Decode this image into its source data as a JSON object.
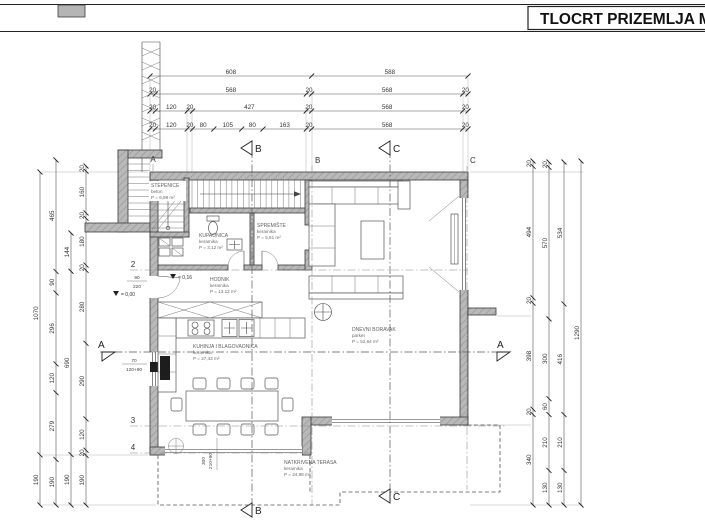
{
  "header": {
    "title": "TLOCRT PRIZEMLJA  M"
  },
  "rooms": [
    {
      "name": "STEPENICE",
      "material": "beton",
      "area": "P = 6,98 m²"
    },
    {
      "name": "KUPAONICA",
      "material": "keramika",
      "area": "P = 3,12 m²"
    },
    {
      "name": "SPREMIŠTE",
      "material": "keramika",
      "area": "P = 5,61 m²"
    },
    {
      "name": "HODNIK",
      "material": "keramika",
      "area": "P = 13,12 m²"
    },
    {
      "name": "KUHINJA I BLAGOVAONICA",
      "material": "keramika",
      "area": "P = 27,43 m²"
    },
    {
      "name": "DNEVNI BORAVAK",
      "material": "parket",
      "area": "P = 52,64 m²"
    },
    {
      "name": "NATKRIVENA TERASA",
      "material": "keramika",
      "area": "P = 24,98 m²"
    }
  ],
  "dims": {
    "top1": [
      "608",
      "588"
    ],
    "top2": [
      "20",
      "568",
      "20",
      "568",
      "20"
    ],
    "top3": [
      "20",
      "120",
      "20",
      "427",
      "20",
      "568",
      "20"
    ],
    "top4": [
      "20",
      "120",
      "20",
      "80",
      "105",
      "80",
      "163",
      "20",
      "568",
      "20"
    ],
    "left1": [
      "1070",
      "190"
    ],
    "left2": [
      "465",
      "90",
      "296",
      "120",
      "279",
      "190"
    ],
    "left3": [
      "144",
      "690",
      "190"
    ],
    "left4": [
      "20",
      "160",
      "20",
      "180",
      "20",
      "280",
      "290",
      "120",
      "20",
      "190"
    ],
    "right1": [
      "20",
      "494",
      "20",
      "398",
      "20",
      "340"
    ],
    "right2": [
      "20",
      "570",
      "300",
      "60",
      "210",
      "130"
    ],
    "right3": [
      "534",
      "416",
      "210",
      "130"
    ],
    "right4": [
      "1290"
    ]
  },
  "grid": {
    "a": "A",
    "b": "B",
    "c": "C",
    "n2": "2",
    "n3": "3",
    "n4": "4"
  },
  "sections": {
    "a": "A",
    "b": "B",
    "c": "C"
  },
  "openings": {
    "entry_door_width": "90",
    "entry_door_height": "220",
    "kitchen_window_width": "70",
    "kitchen_window_height": "120+90",
    "terrace_window_width": "300",
    "terrace_window_height": "210+90"
  },
  "elevations": {
    "entry": "= 0,00",
    "hodnik": "= 0,16"
  }
}
